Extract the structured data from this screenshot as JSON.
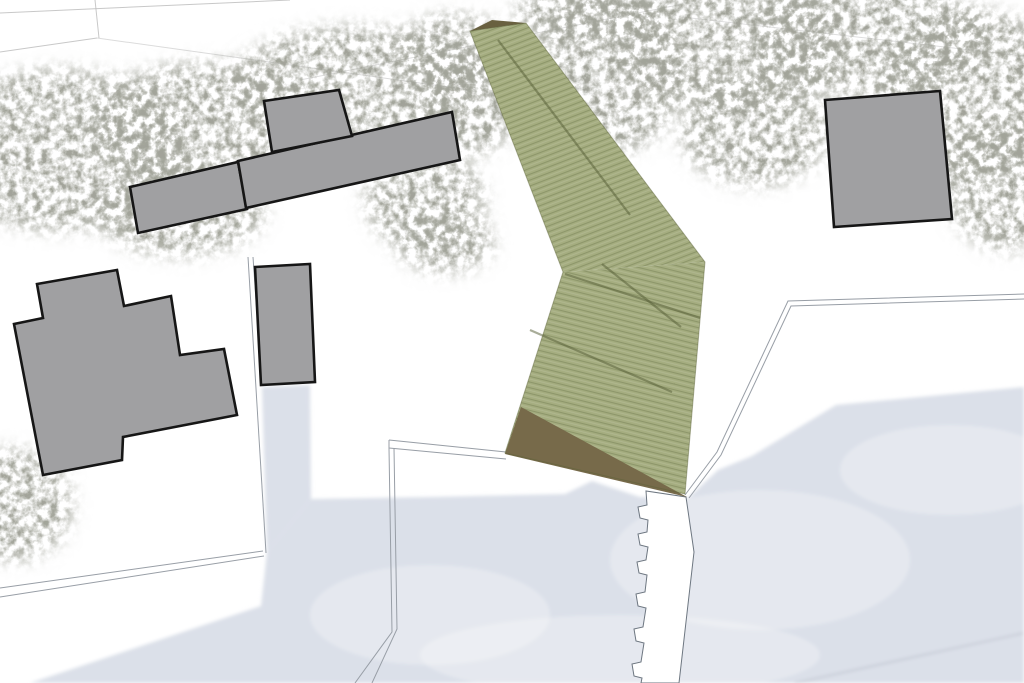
{
  "scene": {
    "label": "architectural-site-plan",
    "w": 1024,
    "h": 683,
    "bg": "#ffffff"
  },
  "colors": {
    "road": "#bfbfbf",
    "water": "#dbe0e9",
    "water_line": "#b2b8c3",
    "path": "#989ea6",
    "jetty_stroke": "#6d7680",
    "building_fill": "#a0a0a2",
    "building_stroke": "#161616",
    "deck_fill": "#a5ad80",
    "deck_edge": "#5a6138",
    "seam": "#545c34",
    "brown_top": "#696040",
    "brown_bottom": "#776a4a",
    "veg_base": "#777a6e"
  },
  "roads": [
    [
      0,
      13,
      290,
      0,
      0.85
    ],
    [
      95,
      0,
      99,
      38,
      0.85
    ],
    [
      0,
      52,
      97,
      38,
      0.85
    ],
    [
      97,
      38,
      470,
      90,
      0.55
    ],
    [
      300,
      80,
      683,
      4,
      0.5
    ],
    [
      682,
      17,
      1024,
      56,
      0.5
    ]
  ],
  "water": {
    "main": [
      [
        311,
        499
      ],
      [
        430,
        497
      ],
      [
        565,
        494
      ],
      [
        592,
        481
      ],
      [
        640,
        497
      ],
      [
        688,
        498
      ],
      [
        718,
        470
      ],
      [
        752,
        456
      ],
      [
        836,
        405
      ],
      [
        1024,
        387
      ],
      [
        1024,
        683
      ],
      [
        30,
        683
      ],
      [
        261,
        606
      ],
      [
        267,
        552
      ]
    ],
    "inlet": [
      [
        262,
        387
      ],
      [
        310,
        385
      ],
      [
        311,
        499
      ],
      [
        267,
        552
      ]
    ],
    "highlights": [
      [
        760,
        560,
        150,
        70
      ],
      [
        430,
        615,
        120,
        50
      ],
      [
        950,
        470,
        110,
        45
      ],
      [
        620,
        655,
        200,
        40
      ]
    ],
    "shore_line": [
      795,
      683,
      1024,
      633
    ]
  },
  "vegetation": [
    [
      60,
      150,
      130,
      80
    ],
    [
      205,
      125,
      115,
      62
    ],
    [
      355,
      85,
      125,
      58
    ],
    [
      455,
      55,
      60,
      40
    ],
    [
      180,
      210,
      85,
      45
    ],
    [
      425,
      200,
      60,
      48
    ],
    [
      445,
      242,
      48,
      30
    ],
    [
      470,
      100,
      48,
      55
    ],
    [
      608,
      70,
      75,
      85
    ],
    [
      730,
      45,
      115,
      65
    ],
    [
      755,
      130,
      75,
      55
    ],
    [
      870,
      40,
      120,
      58
    ],
    [
      975,
      95,
      95,
      85
    ],
    [
      1010,
      185,
      65,
      65
    ],
    [
      12,
      505,
      60,
      55
    ],
    [
      585,
      12,
      70,
      30
    ]
  ],
  "paths": [
    [
      [
        248,
        257
      ],
      [
        266,
        553
      ]
    ],
    [
      [
        253,
        257
      ],
      [
        262,
        386
      ]
    ],
    [
      [
        0,
        588
      ],
      [
        263,
        551
      ]
    ],
    [
      [
        0,
        597
      ],
      [
        264,
        556
      ]
    ],
    [
      [
        1024,
        294
      ],
      [
        788,
        301
      ],
      [
        717,
        452
      ],
      [
        685,
        495
      ]
    ],
    [
      [
        1024,
        299
      ],
      [
        791,
        306
      ],
      [
        721,
        455
      ],
      [
        689,
        498
      ]
    ],
    [
      [
        389,
        440
      ],
      [
        506,
        452
      ]
    ],
    [
      [
        389,
        448
      ],
      [
        506,
        459
      ]
    ],
    [
      [
        389,
        440
      ],
      [
        389,
        448
      ]
    ],
    [
      [
        389,
        448
      ],
      [
        392,
        632
      ],
      [
        355,
        683
      ]
    ],
    [
      [
        394,
        448
      ],
      [
        397,
        629
      ],
      [
        372,
        683
      ]
    ]
  ],
  "jetty": [
    [
      646,
      491
    ],
    [
      647,
      505
    ],
    [
      638,
      507
    ],
    [
      640,
      518
    ],
    [
      648,
      520
    ],
    [
      647,
      532
    ],
    [
      638,
      534
    ],
    [
      640,
      545
    ],
    [
      648,
      547
    ],
    [
      646,
      560
    ],
    [
      637,
      562
    ],
    [
      639,
      573
    ],
    [
      647,
      575
    ],
    [
      645,
      592
    ],
    [
      636,
      594
    ],
    [
      638,
      606
    ],
    [
      646,
      608
    ],
    [
      643,
      627
    ],
    [
      634,
      629
    ],
    [
      636,
      641
    ],
    [
      644,
      643
    ],
    [
      641,
      662
    ],
    [
      632,
      664
    ],
    [
      634,
      676
    ],
    [
      642,
      678
    ],
    [
      641,
      683
    ],
    [
      679,
      683
    ],
    [
      694,
      552
    ],
    [
      686,
      497
    ]
  ],
  "buildings": [
    {
      "name": "building-row-left-rect",
      "points": [
        [
          130,
          187
        ],
        [
          238,
          162
        ],
        [
          247,
          209
        ],
        [
          138,
          233
        ]
      ]
    },
    {
      "name": "building-row-long-rect",
      "points": [
        [
          238,
          161
        ],
        [
          452,
          112
        ],
        [
          460,
          160
        ],
        [
          246,
          208
        ]
      ]
    },
    {
      "name": "building-row-top-rect",
      "points": [
        [
          264,
          101
        ],
        [
          339,
          90
        ],
        [
          352,
          136
        ],
        [
          272,
          152
        ]
      ]
    },
    {
      "name": "building-right-square",
      "points": [
        [
          825,
          100
        ],
        [
          940,
          91
        ],
        [
          952,
          219
        ],
        [
          834,
          227
        ]
      ]
    },
    {
      "name": "building-small-rect",
      "points": [
        [
          255,
          267
        ],
        [
          310,
          264
        ],
        [
          315,
          382
        ],
        [
          261,
          385
        ]
      ]
    },
    {
      "name": "building-large-irregular",
      "points": [
        [
          117,
          270
        ],
        [
          124,
          306
        ],
        [
          171,
          296
        ],
        [
          180,
          355
        ],
        [
          224,
          349
        ],
        [
          237,
          415
        ],
        [
          123,
          437
        ],
        [
          122,
          460
        ],
        [
          43,
          475
        ],
        [
          14,
          324
        ],
        [
          43,
          318
        ],
        [
          37,
          284
        ]
      ]
    }
  ],
  "deck": {
    "upper": [
      [
        470,
        31
      ],
      [
        526,
        23
      ],
      [
        705,
        262
      ],
      [
        563,
        272
      ]
    ],
    "lower": [
      [
        563,
        272
      ],
      [
        705,
        262
      ],
      [
        685,
        494
      ],
      [
        505,
        453
      ]
    ],
    "outline": [
      [
        470,
        31
      ],
      [
        526,
        23
      ],
      [
        705,
        262
      ],
      [
        685,
        494
      ],
      [
        505,
        453
      ],
      [
        563,
        272
      ]
    ],
    "brown_top": [
      [
        470,
        31
      ],
      [
        492,
        20
      ],
      [
        526,
        23
      ]
    ],
    "brown_bottom": [
      [
        521,
        407
      ],
      [
        505,
        454
      ],
      [
        687,
        497
      ]
    ],
    "seams": [
      [
        [
          498,
          40
        ],
        [
          630,
          215
        ]
      ],
      [
        [
          602,
          264
        ],
        [
          681,
          327
        ]
      ],
      [
        [
          565,
          274
        ],
        [
          700,
          318
        ]
      ],
      [
        [
          530,
          330
        ],
        [
          672,
          392
        ]
      ]
    ]
  }
}
